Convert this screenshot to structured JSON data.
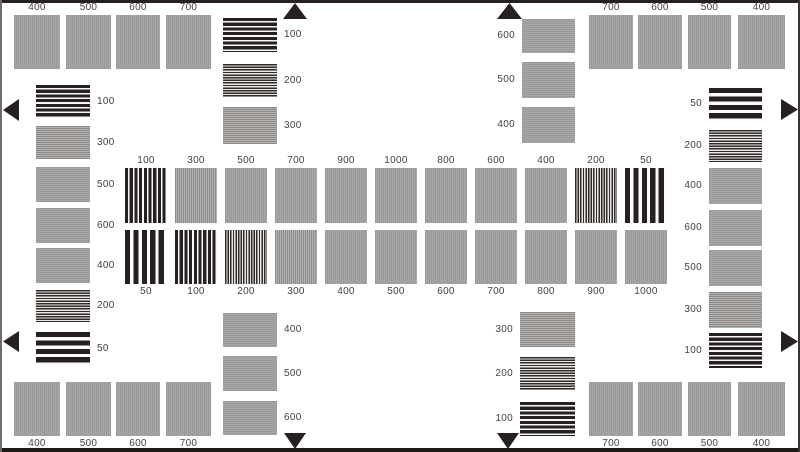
{
  "colors": {
    "background": "#ffffff",
    "bar_black": "#262120",
    "gray_base": "#a3a1a0",
    "label_text": "#45423f",
    "frame_dark": "#262120"
  },
  "groups": [
    {
      "name": "top-left-corner",
      "stripes": "v",
      "label_side": "above",
      "blocks": [
        {
          "label": "400",
          "freq": 400,
          "x": 14,
          "y": 15,
          "w": 46,
          "h": 54
        },
        {
          "label": "500",
          "freq": 500,
          "x": 66,
          "y": 15,
          "w": 45,
          "h": 54
        },
        {
          "label": "600",
          "freq": 600,
          "x": 116,
          "y": 15,
          "w": 44,
          "h": 54
        },
        {
          "label": "700",
          "freq": 700,
          "x": 166,
          "y": 15,
          "w": 45,
          "h": 54
        }
      ]
    },
    {
      "name": "top-right-corner",
      "stripes": "v",
      "label_side": "above",
      "blocks": [
        {
          "label": "700",
          "freq": 700,
          "x": 589,
          "y": 15,
          "w": 44,
          "h": 54
        },
        {
          "label": "600",
          "freq": 600,
          "x": 638,
          "y": 15,
          "w": 44,
          "h": 54
        },
        {
          "label": "500",
          "freq": 500,
          "x": 688,
          "y": 15,
          "w": 43,
          "h": 54
        },
        {
          "label": "400",
          "freq": 400,
          "x": 738,
          "y": 15,
          "w": 47,
          "h": 54
        }
      ]
    },
    {
      "name": "bottom-left-corner",
      "stripes": "v",
      "label_side": "below",
      "blocks": [
        {
          "label": "400",
          "freq": 400,
          "x": 14,
          "y": 382,
          "w": 46,
          "h": 54
        },
        {
          "label": "500",
          "freq": 500,
          "x": 66,
          "y": 382,
          "w": 45,
          "h": 54
        },
        {
          "label": "600",
          "freq": 600,
          "x": 116,
          "y": 382,
          "w": 44,
          "h": 54
        },
        {
          "label": "700",
          "freq": 700,
          "x": 166,
          "y": 382,
          "w": 45,
          "h": 54
        }
      ]
    },
    {
      "name": "bottom-right-corner",
      "stripes": "v",
      "label_side": "below",
      "blocks": [
        {
          "label": "700",
          "freq": 700,
          "x": 589,
          "y": 382,
          "w": 44,
          "h": 54
        },
        {
          "label": "600",
          "freq": 600,
          "x": 638,
          "y": 382,
          "w": 44,
          "h": 54
        },
        {
          "label": "500",
          "freq": 500,
          "x": 688,
          "y": 382,
          "w": 43,
          "h": 54
        },
        {
          "label": "400",
          "freq": 400,
          "x": 738,
          "y": 382,
          "w": 47,
          "h": 54
        }
      ]
    },
    {
      "name": "left-column",
      "stripes": "h",
      "label_side": "right",
      "blocks": [
        {
          "label": "100",
          "freq": 100,
          "x": 36,
          "y": 85,
          "w": 54,
          "h": 33
        },
        {
          "label": "300",
          "freq": 300,
          "x": 36,
          "y": 126,
          "w": 54,
          "h": 33
        },
        {
          "label": "500",
          "freq": 500,
          "x": 36,
          "y": 167,
          "w": 54,
          "h": 35
        },
        {
          "label": "600",
          "freq": 600,
          "x": 36,
          "y": 208,
          "w": 54,
          "h": 35
        },
        {
          "label": "400",
          "freq": 400,
          "x": 36,
          "y": 248,
          "w": 54,
          "h": 35
        },
        {
          "label": "200",
          "freq": 200,
          "x": 36,
          "y": 290,
          "w": 54,
          "h": 32
        },
        {
          "label": "50",
          "freq": 50,
          "x": 36,
          "y": 332,
          "w": 54,
          "h": 33
        }
      ]
    },
    {
      "name": "right-column",
      "stripes": "h",
      "label_side": "left",
      "blocks": [
        {
          "label": "50",
          "freq": 50,
          "x": 709,
          "y": 88,
          "w": 53,
          "h": 32
        },
        {
          "label": "200",
          "freq": 200,
          "x": 709,
          "y": 130,
          "w": 53,
          "h": 32
        },
        {
          "label": "400",
          "freq": 400,
          "x": 709,
          "y": 168,
          "w": 53,
          "h": 36
        },
        {
          "label": "600",
          "freq": 600,
          "x": 709,
          "y": 210,
          "w": 53,
          "h": 36
        },
        {
          "label": "500",
          "freq": 500,
          "x": 709,
          "y": 250,
          "w": 53,
          "h": 36
        },
        {
          "label": "300",
          "freq": 300,
          "x": 709,
          "y": 292,
          "w": 53,
          "h": 36
        },
        {
          "label": "100",
          "freq": 100,
          "x": 709,
          "y": 333,
          "w": 53,
          "h": 35
        }
      ]
    },
    {
      "name": "top-center-left-column",
      "stripes": "h",
      "label_side": "right",
      "blocks": [
        {
          "label": "100",
          "freq": 100,
          "x": 223,
          "y": 18,
          "w": 54,
          "h": 34
        },
        {
          "label": "200",
          "freq": 200,
          "x": 223,
          "y": 64,
          "w": 54,
          "h": 33
        },
        {
          "label": "300",
          "freq": 300,
          "x": 223,
          "y": 107,
          "w": 54,
          "h": 37
        }
      ]
    },
    {
      "name": "top-center-right-column",
      "stripes": "h",
      "label_side": "left",
      "blocks": [
        {
          "label": "600",
          "freq": 600,
          "x": 522,
          "y": 19,
          "w": 53,
          "h": 34
        },
        {
          "label": "500",
          "freq": 500,
          "x": 522,
          "y": 62,
          "w": 53,
          "h": 36
        },
        {
          "label": "400",
          "freq": 400,
          "x": 522,
          "y": 107,
          "w": 53,
          "h": 36
        }
      ]
    },
    {
      "name": "bottom-center-left-column",
      "stripes": "h",
      "label_side": "right",
      "blocks": [
        {
          "label": "400",
          "freq": 400,
          "x": 223,
          "y": 313,
          "w": 54,
          "h": 34
        },
        {
          "label": "500",
          "freq": 500,
          "x": 223,
          "y": 356,
          "w": 54,
          "h": 35
        },
        {
          "label": "600",
          "freq": 600,
          "x": 223,
          "y": 401,
          "w": 54,
          "h": 34
        }
      ]
    },
    {
      "name": "bottom-center-right-column",
      "stripes": "h",
      "label_side": "left",
      "blocks": [
        {
          "label": "300",
          "freq": 300,
          "x": 520,
          "y": 312,
          "w": 55,
          "h": 35
        },
        {
          "label": "200",
          "freq": 200,
          "x": 520,
          "y": 357,
          "w": 55,
          "h": 33
        },
        {
          "label": "100",
          "freq": 100,
          "x": 520,
          "y": 402,
          "w": 55,
          "h": 34
        }
      ]
    },
    {
      "name": "center-top-row",
      "stripes": "v",
      "label_side": "above",
      "blocks": [
        {
          "label": "100",
          "freq": 100,
          "x": 125,
          "y": 168,
          "w": 42,
          "h": 55
        },
        {
          "label": "300",
          "freq": 300,
          "x": 175,
          "y": 168,
          "w": 42,
          "h": 55
        },
        {
          "label": "500",
          "freq": 500,
          "x": 225,
          "y": 168,
          "w": 42,
          "h": 55
        },
        {
          "label": "700",
          "freq": 700,
          "x": 275,
          "y": 168,
          "w": 42,
          "h": 55
        },
        {
          "label": "900",
          "freq": 900,
          "x": 325,
          "y": 168,
          "w": 42,
          "h": 55
        },
        {
          "label": "1000",
          "freq": 1000,
          "x": 375,
          "y": 168,
          "w": 42,
          "h": 55
        },
        {
          "label": "800",
          "freq": 800,
          "x": 425,
          "y": 168,
          "w": 42,
          "h": 55
        },
        {
          "label": "600",
          "freq": 600,
          "x": 475,
          "y": 168,
          "w": 42,
          "h": 55
        },
        {
          "label": "400",
          "freq": 400,
          "x": 525,
          "y": 168,
          "w": 42,
          "h": 55
        },
        {
          "label": "200",
          "freq": 200,
          "x": 575,
          "y": 168,
          "w": 42,
          "h": 55
        },
        {
          "label": "50",
          "freq": 50,
          "x": 625,
          "y": 168,
          "w": 42,
          "h": 55
        }
      ]
    },
    {
      "name": "center-bottom-row",
      "stripes": "v",
      "label_side": "below",
      "blocks": [
        {
          "label": "50",
          "freq": 50,
          "x": 125,
          "y": 230,
          "w": 42,
          "h": 54
        },
        {
          "label": "100",
          "freq": 100,
          "x": 175,
          "y": 230,
          "w": 42,
          "h": 54
        },
        {
          "label": "200",
          "freq": 200,
          "x": 225,
          "y": 230,
          "w": 42,
          "h": 54
        },
        {
          "label": "300",
          "freq": 300,
          "x": 275,
          "y": 230,
          "w": 42,
          "h": 54
        },
        {
          "label": "400",
          "freq": 400,
          "x": 325,
          "y": 230,
          "w": 42,
          "h": 54
        },
        {
          "label": "500",
          "freq": 500,
          "x": 375,
          "y": 230,
          "w": 42,
          "h": 54
        },
        {
          "label": "600",
          "freq": 600,
          "x": 425,
          "y": 230,
          "w": 42,
          "h": 54
        },
        {
          "label": "700",
          "freq": 700,
          "x": 475,
          "y": 230,
          "w": 42,
          "h": 54
        },
        {
          "label": "800",
          "freq": 800,
          "x": 525,
          "y": 230,
          "w": 42,
          "h": 54
        },
        {
          "label": "900",
          "freq": 900,
          "x": 575,
          "y": 230,
          "w": 42,
          "h": 54
        },
        {
          "label": "1000",
          "freq": 1000,
          "x": 625,
          "y": 230,
          "w": 42,
          "h": 54
        }
      ]
    }
  ],
  "markers": [
    {
      "name": "top-marker-left",
      "dir": "up",
      "x": 283,
      "y": 3,
      "w": 24,
      "h": 16
    },
    {
      "name": "top-marker-right",
      "dir": "up",
      "x": 497,
      "y": 3,
      "w": 25,
      "h": 16
    },
    {
      "name": "bottom-marker-left",
      "dir": "down",
      "x": 284,
      "y": 433,
      "w": 22,
      "h": 16
    },
    {
      "name": "bottom-marker-right",
      "dir": "down",
      "x": 497,
      "y": 433,
      "w": 22,
      "h": 16
    },
    {
      "name": "left-marker-top",
      "dir": "left",
      "x": 3,
      "y": 99,
      "w": 16,
      "h": 22
    },
    {
      "name": "left-marker-bottom",
      "dir": "left",
      "x": 3,
      "y": 331,
      "w": 16,
      "h": 21
    },
    {
      "name": "right-marker-top",
      "dir": "right",
      "x": 781,
      "y": 99,
      "w": 17,
      "h": 21
    },
    {
      "name": "right-marker-bottom",
      "dir": "right",
      "x": 781,
      "y": 331,
      "w": 17,
      "h": 21
    }
  ]
}
